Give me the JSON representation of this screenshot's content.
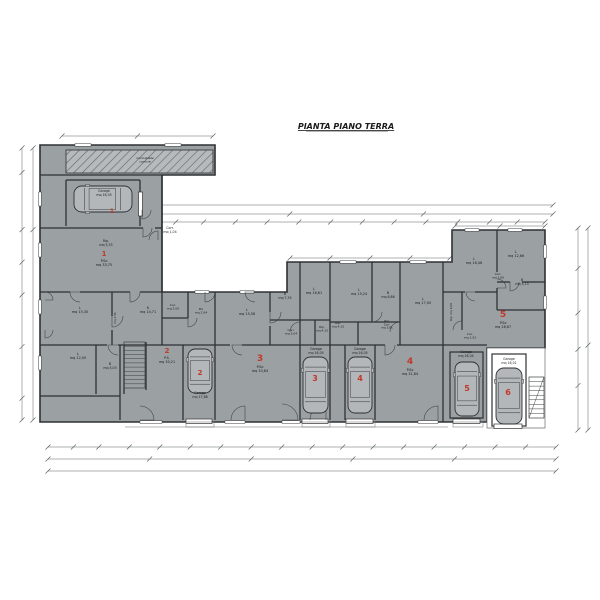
{
  "title": {
    "text": "PIANTA PIANO TERRA"
  },
  "palette": {
    "building": "#9ba0a3",
    "wall": "#2e3134",
    "thin": "#6a6e71",
    "dim": "#5f6366",
    "red": "#c0392b",
    "car": "#b3b7b9",
    "white": "#ffffff",
    "text": "#1b1b1b",
    "hatch_bg": "#b6babd",
    "hatch_line": "#5e6366"
  },
  "plan": {
    "outline": [
      [
        40,
        145
      ],
      [
        215,
        145
      ],
      [
        215,
        175
      ],
      [
        162,
        175
      ],
      [
        162,
        292
      ],
      [
        287,
        292
      ],
      [
        287,
        262
      ],
      [
        452,
        262
      ],
      [
        452,
        230
      ],
      [
        545,
        230
      ],
      [
        545,
        348
      ],
      [
        487,
        348
      ],
      [
        487,
        422
      ],
      [
        40,
        422
      ]
    ],
    "white_blocks": [
      [
        [
          487,
          348
        ],
        [
          545,
          348
        ],
        [
          545,
          428
        ],
        [
          487,
          428
        ]
      ]
    ],
    "hatch_rect": [
      66,
      150,
      147,
      23
    ],
    "walls": [
      [
        40,
        175,
        162,
        175
      ],
      [
        40,
        228,
        143,
        228
      ],
      [
        155,
        228,
        162,
        228
      ],
      [
        66,
        180,
        66,
        226
      ],
      [
        140,
        180,
        140,
        226
      ],
      [
        66,
        180,
        140,
        180
      ],
      [
        162,
        175,
        162,
        345
      ],
      [
        40,
        292,
        70,
        292
      ],
      [
        80,
        292,
        130,
        292
      ],
      [
        140,
        292,
        162,
        292
      ],
      [
        112,
        292,
        112,
        316
      ],
      [
        112,
        330,
        112,
        345
      ],
      [
        40,
        345,
        107,
        345
      ],
      [
        118,
        345,
        230,
        345
      ],
      [
        242,
        345,
        385,
        345
      ],
      [
        397,
        345,
        487,
        345
      ],
      [
        96,
        345,
        96,
        394
      ],
      [
        124,
        345,
        124,
        394
      ],
      [
        40,
        396,
        120,
        396
      ],
      [
        120,
        345,
        120,
        420
      ],
      [
        146,
        342,
        146,
        390
      ],
      [
        183,
        345,
        183,
        420
      ],
      [
        215,
        292,
        215,
        420
      ],
      [
        188,
        292,
        188,
        318
      ],
      [
        162,
        318,
        188,
        318
      ],
      [
        270,
        292,
        270,
        312
      ],
      [
        270,
        326,
        270,
        345
      ],
      [
        300,
        262,
        300,
        345
      ],
      [
        270,
        320,
        330,
        320
      ],
      [
        315,
        320,
        315,
        345
      ],
      [
        330,
        262,
        330,
        420
      ],
      [
        372,
        262,
        372,
        322
      ],
      [
        400,
        262,
        400,
        345
      ],
      [
        330,
        322,
        400,
        322
      ],
      [
        358,
        322,
        358,
        345
      ],
      [
        345,
        345,
        345,
        420
      ],
      [
        375,
        345,
        375,
        420
      ],
      [
        443,
        262,
        443,
        422
      ],
      [
        300,
        345,
        300,
        420
      ],
      [
        497,
        230,
        497,
        272
      ],
      [
        497,
        288,
        497,
        310
      ],
      [
        497,
        282,
        510,
        282
      ],
      [
        522,
        282,
        545,
        282
      ],
      [
        497,
        310,
        545,
        310
      ],
      [
        443,
        292,
        465,
        292
      ],
      [
        475,
        292,
        497,
        292
      ],
      [
        462,
        292,
        462,
        330
      ]
    ],
    "wall_rects": [
      [
        450,
        352,
        33,
        66
      ],
      [
        492,
        354,
        34,
        72
      ]
    ],
    "thin_lines": [
      [
        125,
        427,
        448,
        427
      ],
      [
        306,
        131.5,
        388,
        131.5
      ]
    ],
    "windows": [
      [
        38.7,
        192,
        2.6,
        14
      ],
      [
        38.7,
        243,
        2.6,
        14
      ],
      [
        38.7,
        300,
        2.6,
        14
      ],
      [
        38.7,
        356,
        2.6,
        14
      ],
      [
        75,
        143.7,
        16,
        2.6
      ],
      [
        165,
        143.7,
        16,
        2.6
      ],
      [
        340,
        260.7,
        16,
        2.6
      ],
      [
        410,
        260.7,
        16,
        2.6
      ],
      [
        465,
        228.7,
        14,
        2.6
      ],
      [
        508,
        228.7,
        14,
        2.6
      ],
      [
        543.7,
        245,
        2.6,
        13
      ],
      [
        543.7,
        296,
        2.6,
        13
      ],
      [
        195,
        290.7,
        14,
        2.6
      ],
      [
        240,
        290.7,
        14,
        2.6
      ],
      [
        140,
        420.7,
        22,
        2.6
      ],
      [
        225,
        420.7,
        20,
        2.6
      ],
      [
        282,
        420.7,
        18,
        2.6
      ],
      [
        308,
        420.7,
        18,
        2.6
      ],
      [
        418,
        420.7,
        20,
        2.6
      ]
    ],
    "garage_doors": [
      [
        186,
        419,
        26,
        4.5
      ],
      [
        302,
        419,
        26,
        4.5
      ],
      [
        346,
        419,
        27,
        4.5
      ],
      [
        453,
        419,
        27,
        4.5
      ],
      [
        494,
        424,
        28,
        4.5
      ],
      [
        138.5,
        192,
        4,
        24
      ]
    ],
    "aprons": [
      [
        186,
        422,
        28,
        5
      ],
      [
        302,
        422,
        28,
        5
      ],
      [
        346,
        422,
        29,
        5
      ],
      [
        453,
        422,
        30,
        5
      ]
    ],
    "stairs": [
      {
        "x": 124,
        "y": 342,
        "w": 21,
        "h": 46,
        "n": 10,
        "diag": false
      },
      {
        "x": 529,
        "y": 377,
        "w": 15,
        "h": 41,
        "n": 8,
        "diag": true
      }
    ],
    "cars": [
      {
        "x": 74,
        "y": 186,
        "w": 58,
        "h": 26,
        "o": "h"
      },
      {
        "x": 188,
        "y": 349,
        "w": 24,
        "h": 44,
        "o": "v"
      },
      {
        "x": 303,
        "y": 357,
        "w": 25,
        "h": 56,
        "o": "v"
      },
      {
        "x": 348,
        "y": 357,
        "w": 24,
        "h": 56,
        "o": "v"
      },
      {
        "x": 455,
        "y": 362,
        "w": 24,
        "h": 54,
        "o": "v"
      },
      {
        "x": 496,
        "y": 368,
        "w": 26,
        "h": 56,
        "o": "v"
      }
    ],
    "doors": [
      {
        "cx": 118,
        "cy": 345,
        "r": 10,
        "a0": 180,
        "a1": 270
      },
      {
        "cx": 242,
        "cy": 345,
        "r": 10,
        "a0": 180,
        "a1": 270
      },
      {
        "cx": 385,
        "cy": 345,
        "r": 10,
        "a0": 270,
        "a1": 360
      },
      {
        "cx": 80,
        "cy": 292,
        "r": 10,
        "a0": 180,
        "a1": 270
      },
      {
        "cx": 130,
        "cy": 292,
        "r": 10,
        "a0": 270,
        "a1": 360
      },
      {
        "cx": 143,
        "cy": 228,
        "r": 9,
        "a0": 270,
        "a1": 360
      },
      {
        "cx": 140,
        "cy": 420,
        "r": 14,
        "a0": 0,
        "a1": 90
      },
      {
        "cx": 245,
        "cy": 420,
        "r": 14,
        "a0": 90,
        "a1": 180
      },
      {
        "cx": 282,
        "cy": 420,
        "r": 16,
        "a0": 0,
        "a1": 90
      },
      {
        "cx": 326,
        "cy": 420,
        "r": 16,
        "a0": 90,
        "a1": 180
      },
      {
        "cx": 438,
        "cy": 420,
        "r": 14,
        "a0": 90,
        "a1": 180
      },
      {
        "cx": 112,
        "cy": 316,
        "r": 11,
        "a0": 270,
        "a1": 360
      },
      {
        "cx": 270,
        "cy": 312,
        "r": 11,
        "a0": 270,
        "a1": 360
      },
      {
        "cx": 300,
        "cy": 332,
        "r": 10,
        "a0": 90,
        "a1": 180
      },
      {
        "cx": 372,
        "cy": 312,
        "r": 10,
        "a0": 270,
        "a1": 360
      },
      {
        "cx": 400,
        "cy": 332,
        "r": 10,
        "a0": 90,
        "a1": 180
      },
      {
        "cx": 497,
        "cy": 288,
        "r": 9,
        "a0": 0,
        "a1": 90
      },
      {
        "cx": 510,
        "cy": 282,
        "r": 9,
        "a0": 270,
        "a1": 360
      },
      {
        "cx": 475,
        "cy": 292,
        "r": 9,
        "a0": 180,
        "a1": 270
      },
      {
        "cx": 462,
        "cy": 330,
        "r": 9,
        "a0": 90,
        "a1": 180
      },
      {
        "cx": 188,
        "cy": 318,
        "r": 9,
        "a0": 270,
        "a1": 360
      },
      {
        "cx": 45,
        "cy": 300,
        "r": 8,
        "a0": 0,
        "a1": 90
      },
      {
        "cx": 45,
        "cy": 330,
        "r": 8,
        "a0": 270,
        "a1": 360
      },
      {
        "cx": 205,
        "cy": 292,
        "r": 10,
        "a0": 270,
        "a1": 360
      },
      {
        "cx": 255,
        "cy": 292,
        "r": 10,
        "a0": 180,
        "a1": 270
      },
      {
        "cx": 142,
        "cy": 210,
        "r": 9,
        "a0": 270,
        "a1": 360
      },
      {
        "cx": 158,
        "cy": 240,
        "r": 9,
        "a0": 90,
        "a1": 180
      }
    ],
    "labels": [
      {
        "l": [
          "Garage",
          "mq 16,05"
        ],
        "x": 104,
        "y": 192,
        "s": 3.2
      },
      {
        "l": [
          "Rip.",
          "mq 5,35"
        ],
        "x": 106,
        "y": 242,
        "s": 3.2
      },
      {
        "l": [
          "Corr.",
          "mq 1,04"
        ],
        "x": 170,
        "y": 229,
        "s": 3.2
      },
      {
        "l": [
          "P.So",
          "mq 33,75"
        ],
        "x": 104,
        "y": 262,
        "s": 3.4
      },
      {
        "l": [
          "L",
          "mq 15,30"
        ],
        "x": 80,
        "y": 309,
        "s": 3.4
      },
      {
        "l": [
          "K",
          "mq 14,71"
        ],
        "x": 148,
        "y": 309,
        "s": 3.4
      },
      {
        "l": [
          "L",
          "mq 12,00"
        ],
        "x": 78,
        "y": 355,
        "s": 3.4
      },
      {
        "l": [
          "B",
          "mq 5,03"
        ],
        "x": 110,
        "y": 365,
        "s": 3.2
      },
      {
        "l": [
          "mq 2,51"
        ],
        "x": 116,
        "y": 318,
        "s": 2.8,
        "r": -90
      },
      {
        "l": [
          "Cuc.",
          "mq 2,00"
        ],
        "x": 173,
        "y": 306,
        "s": 3
      },
      {
        "l": [
          "B1",
          "mq 2,94"
        ],
        "x": 201,
        "y": 310,
        "s": 3
      },
      {
        "l": [
          "P.S.",
          "mq 30,21"
        ],
        "x": 167,
        "y": 359,
        "s": 3.4
      },
      {
        "l": [
          "Garage",
          "mq 17,88"
        ],
        "x": 200,
        "y": 394,
        "s": 3.2
      },
      {
        "l": [
          "L",
          "mq 15,58"
        ],
        "x": 247,
        "y": 311,
        "s": 3.4
      },
      {
        "l": [
          "B",
          "mq 7,35"
        ],
        "x": 285,
        "y": 295,
        "s": 3.2
      },
      {
        "l": [
          "L",
          "mq 16,61"
        ],
        "x": 314,
        "y": 290,
        "s": 3.4
      },
      {
        "l": [
          "Rip.",
          "mq 4,10"
        ],
        "x": 322,
        "y": 328,
        "s": 3
      },
      {
        "l": [
          "Corr.",
          "mq 3,04"
        ],
        "x": 291,
        "y": 331,
        "s": 3
      },
      {
        "l": [
          "P.So",
          "mq 33,84"
        ],
        "x": 260,
        "y": 368,
        "s": 3.4
      },
      {
        "l": [
          "Garage",
          "mq 16,05"
        ],
        "x": 316,
        "y": 350,
        "s": 3.2
      },
      {
        "l": [
          "L",
          "mq 15,24"
        ],
        "x": 359,
        "y": 291,
        "s": 3.4
      },
      {
        "l": [
          "B",
          "mq 6,86"
        ],
        "x": 388,
        "y": 294,
        "s": 3.2
      },
      {
        "l": [
          "L",
          "mq 17,00"
        ],
        "x": 423,
        "y": 300,
        "s": 3.4
      },
      {
        "l": [
          "Rip.",
          "mq 4,10"
        ],
        "x": 338,
        "y": 324,
        "s": 3
      },
      {
        "l": [
          "W.C.",
          "Corr.",
          "mq 3,81"
        ],
        "x": 387,
        "y": 322,
        "s": 2.8
      },
      {
        "l": [
          "P.So",
          "mq 31,84"
        ],
        "x": 410,
        "y": 371,
        "s": 3.4
      },
      {
        "l": [
          "Garage",
          "mq 16,05"
        ],
        "x": 360,
        "y": 350,
        "s": 3.2
      },
      {
        "l": [
          "Garage",
          "mq 16,04"
        ],
        "x": 466,
        "y": 353,
        "s": 3.2
      },
      {
        "l": [
          "L",
          "mq 16,46"
        ],
        "x": 474,
        "y": 260,
        "s": 3.4
      },
      {
        "l": [
          "L",
          "mq 12,66"
        ],
        "x": 516,
        "y": 253,
        "s": 3.4
      },
      {
        "l": [
          "Corr.",
          "mq 1,69"
        ],
        "x": 498,
        "y": 275,
        "s": 2.8
      },
      {
        "l": [
          "B",
          "mq 5,13"
        ],
        "x": 522,
        "y": 281,
        "s": 3.2
      },
      {
        "l": [
          "Rip. mq 4,09"
        ],
        "x": 452,
        "y": 312,
        "s": 2.8,
        "r": -90
      },
      {
        "l": [
          "P.So",
          "mq 28,67"
        ],
        "x": 503,
        "y": 324,
        "s": 3.4
      },
      {
        "l": [
          "Cuc.",
          "mq 1,52"
        ],
        "x": 470,
        "y": 335,
        "s": 3
      },
      {
        "l": [
          "Garage",
          "mq 16,01"
        ],
        "x": 509,
        "y": 360,
        "s": 3.2
      },
      {
        "l": [
          "marciapiede",
          "comune"
        ],
        "x": 145,
        "y": 159,
        "s": 2.8,
        "i": 1
      }
    ],
    "unit_numbers": [
      {
        "n": "1",
        "x": 112,
        "y": 213,
        "s": 6
      },
      {
        "n": "1",
        "x": 104,
        "y": 256,
        "s": 7
      },
      {
        "n": "2",
        "x": 167,
        "y": 353,
        "s": 7
      },
      {
        "n": "2",
        "x": 200,
        "y": 375,
        "s": 7
      },
      {
        "n": "3",
        "x": 260,
        "y": 361,
        "s": 9
      },
      {
        "n": "3",
        "x": 315,
        "y": 381,
        "s": 8
      },
      {
        "n": "4",
        "x": 410,
        "y": 364,
        "s": 9
      },
      {
        "n": "4",
        "x": 360,
        "y": 381,
        "s": 8
      },
      {
        "n": "5",
        "x": 503,
        "y": 317,
        "s": 9
      },
      {
        "n": "5",
        "x": 467,
        "y": 391,
        "s": 8
      },
      {
        "n": "6",
        "x": 508,
        "y": 395,
        "s": 8
      }
    ],
    "dims": [
      {
        "x1": 22,
        "y1": 148,
        "x2": 22,
        "y2": 420,
        "t": [
          0,
          0.09,
          0.3,
          0.42,
          0.54,
          0.73,
          0.92,
          1
        ]
      },
      {
        "x1": 33,
        "y1": 148,
        "x2": 33,
        "y2": 420,
        "t": [
          0,
          0.3,
          1
        ]
      },
      {
        "x1": 578,
        "y1": 228,
        "x2": 578,
        "y2": 430,
        "t": [
          0,
          0.2,
          0.42,
          0.6,
          0.78,
          1
        ]
      },
      {
        "x1": 588,
        "y1": 228,
        "x2": 588,
        "y2": 430,
        "t": [
          0,
          0.58,
          1
        ]
      },
      {
        "x1": 48,
        "y1": 447,
        "x2": 556,
        "y2": 447,
        "t": [
          0,
          0.05,
          0.1,
          0.16,
          0.22,
          0.28,
          0.34,
          0.4,
          0.46,
          0.52,
          0.58,
          0.64,
          0.7,
          0.76,
          0.82,
          0.88,
          0.94,
          1
        ]
      },
      {
        "x1": 48,
        "y1": 459,
        "x2": 556,
        "y2": 459,
        "t": [
          0,
          0.2,
          0.4,
          0.6,
          0.8,
          1
        ]
      },
      {
        "x1": 48,
        "y1": 471,
        "x2": 556,
        "y2": 471,
        "t": [
          0,
          1
        ]
      },
      {
        "x1": 62,
        "y1": 136,
        "x2": 213,
        "y2": 136,
        "t": [
          0,
          0.5,
          1
        ]
      },
      {
        "x1": 148,
        "y1": 205,
        "x2": 553,
        "y2": 205,
        "t": [
          0,
          1
        ]
      },
      {
        "x1": 148,
        "y1": 214,
        "x2": 553,
        "y2": 214,
        "t": [
          0,
          0.35,
          0.68,
          1
        ]
      },
      {
        "x1": 148,
        "y1": 222,
        "x2": 545,
        "y2": 222,
        "t": [
          0,
          0.07,
          0.14,
          0.22,
          0.3,
          0.38,
          0.46,
          0.54,
          0.62,
          0.7,
          0.78,
          0.86,
          0.93,
          1
        ]
      },
      {
        "x1": 290,
        "y1": 258,
        "x2": 450,
        "y2": 258,
        "t": [
          0,
          0.25,
          0.5,
          0.75,
          1
        ]
      },
      {
        "x1": 455,
        "y1": 226,
        "x2": 545,
        "y2": 226,
        "t": [
          0,
          0.5,
          1
        ]
      }
    ]
  }
}
